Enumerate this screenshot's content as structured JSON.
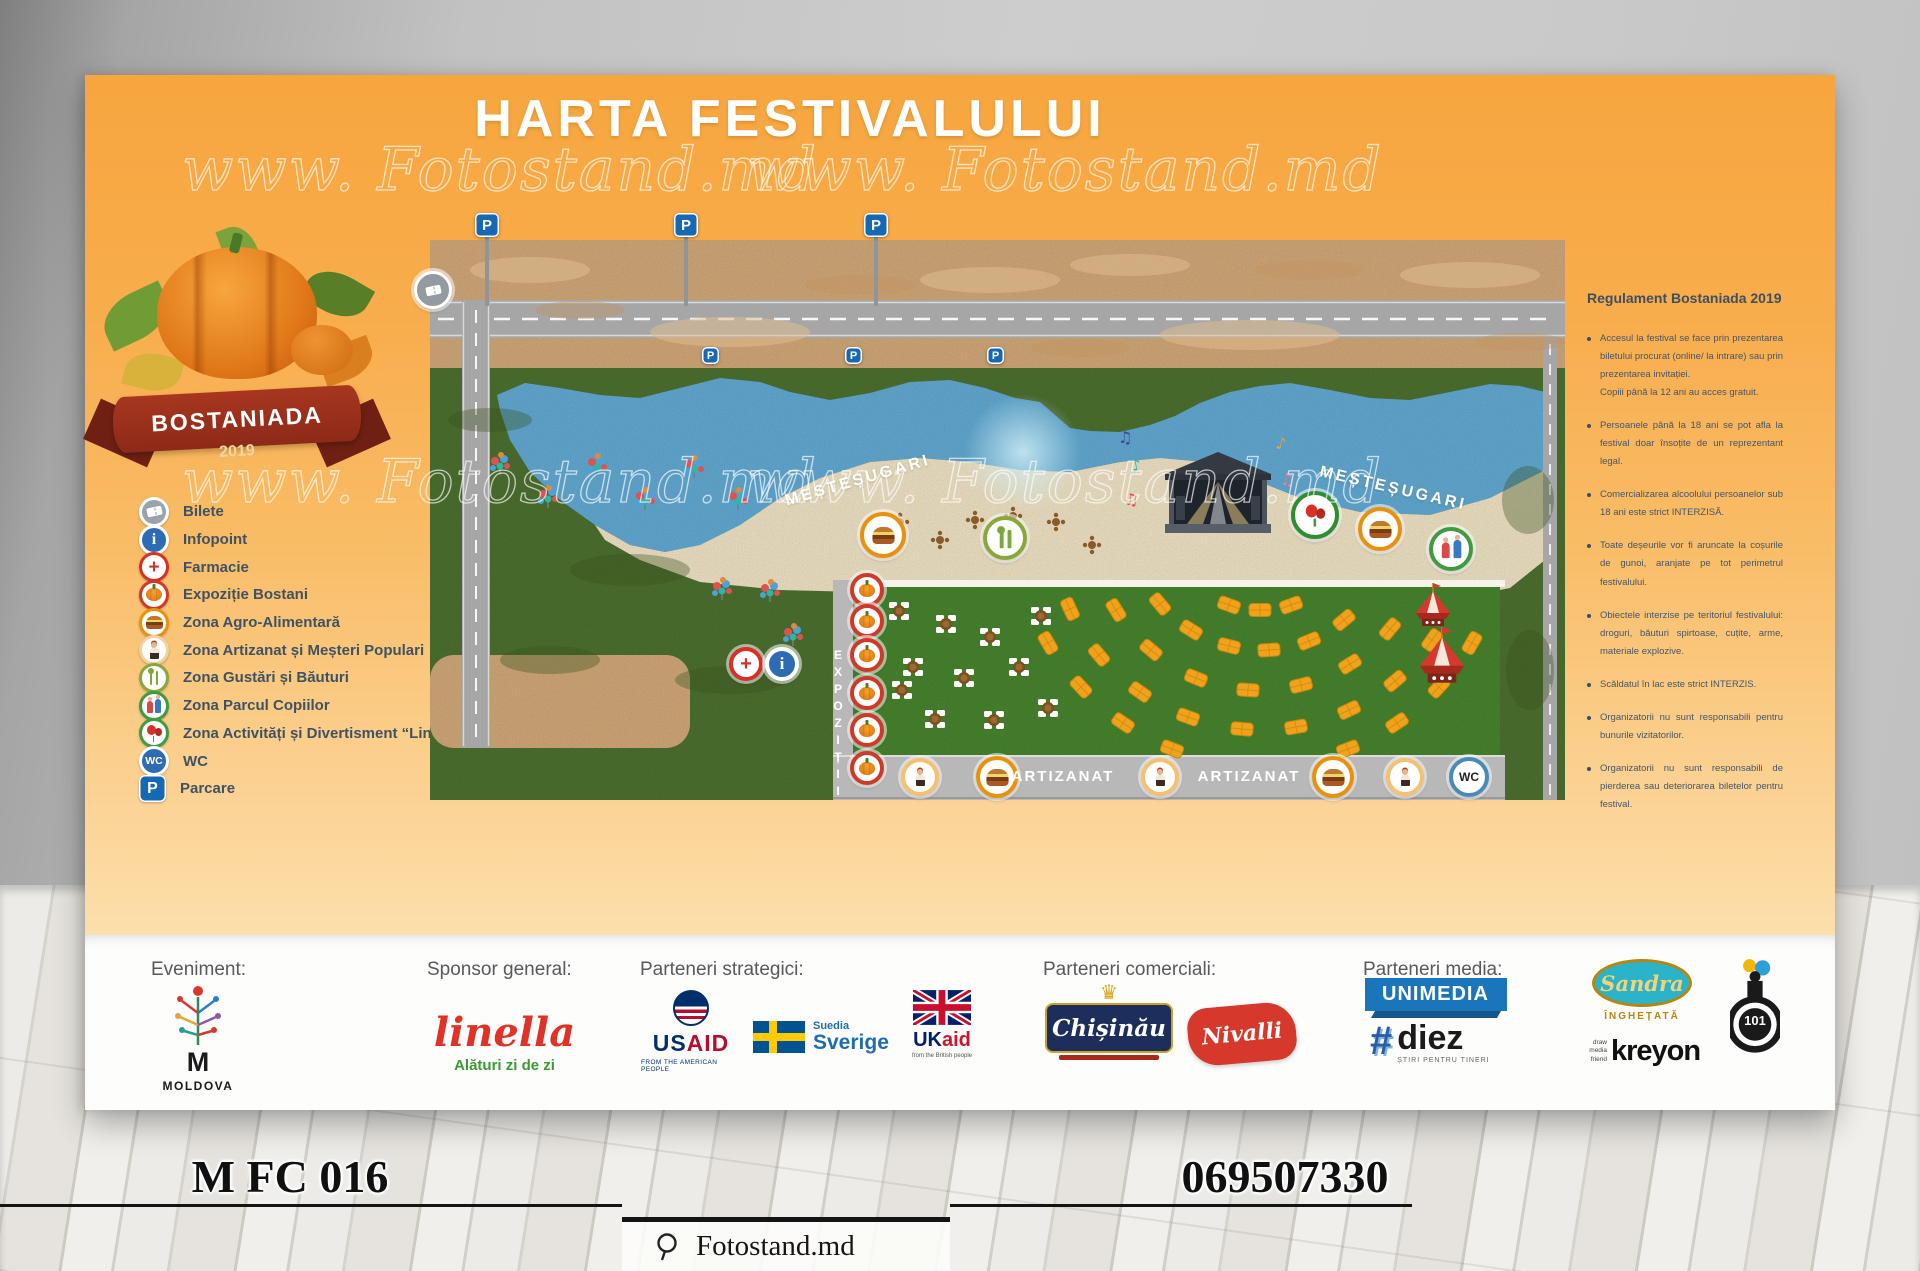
{
  "poster": {
    "title": "HARTA FESTIVALULUI",
    "watermark": "www. Fotostand.md",
    "logo": {
      "name": "BOSTANIADA",
      "year": "2019"
    },
    "legend": {
      "items": [
        {
          "icon": "ticket-icon",
          "label": "Bilete"
        },
        {
          "icon": "info-icon",
          "label": "Infopoint"
        },
        {
          "icon": "pharmacy-icon",
          "label": "Farmacie"
        },
        {
          "icon": "pumpkin-icon",
          "label": "Expoziție Bostani"
        },
        {
          "icon": "food-icon",
          "label": "Zona Agro-Alimentară"
        },
        {
          "icon": "craftsman-icon",
          "label": "Zona Artizanat și Meșteri Populari"
        },
        {
          "icon": "utensils-icon",
          "label": "Zona Gustări și Băuturi"
        },
        {
          "icon": "kids-icon",
          "label": "Zona Parcul Copiilor"
        },
        {
          "icon": "balloons-icon",
          "label": "Zona Activități și Divertisment “Linella”"
        },
        {
          "icon": "wc-icon",
          "label": "WC"
        },
        {
          "icon": "parking-icon",
          "label": "Parcare"
        }
      ]
    },
    "map": {
      "labels": {
        "parking": "P",
        "mestesugari": "MEȘTEȘUGARI",
        "expozitii": "EXPOZIȚII",
        "artizanat": "ARTIZANAT",
        "wc": "WC"
      }
    },
    "rules": {
      "title": "Regulament Bostaniada 2019",
      "bullets": [
        {
          "text": "Accesul la festival se face prin prezentarea biletului procurat (online/ la intrare) sau prin prezentarea invitației.",
          "text2": "Copiii până la 12 ani au acces gratuit."
        },
        {
          "text": "Persoanele până la 18 ani se pot afla la festival doar însoțite de un reprezentant legal."
        },
        {
          "text": "Comercializarea alcoolului persoanelor sub 18 ani este strict INTERZISĂ."
        },
        {
          "text": "Toate deșeurile vor fi aruncate la coșurile de gunoi, aranjate pe tot perimetrul festivalului."
        },
        {
          "text": "Obiectele interzise pe teritoriul festivalului: droguri, băuturi spirtoase, cuțite, arme, materiale explozive."
        },
        {
          "text": "Scăldatul în lac este strict INTERZIS."
        },
        {
          "text": "Organizatorii nu sunt responsabili pentru bunurile vizitatorilor."
        },
        {
          "text": "Organizatorii nu sunt responsabili de pierderea sau deteriorarea biletelor pentru festival."
        }
      ]
    }
  },
  "sponsors": {
    "sections": {
      "event": "Eveniment:",
      "general": "Sponsor general:",
      "strategic": "Parteneri strategici:",
      "commercial": "Parteneri comerciali:",
      "media": "Parteneri media:"
    },
    "moldova": {
      "letter": "M",
      "name": "MOLDOVA"
    },
    "linella": {
      "name": "linella",
      "slogan": "Alături zi de zi"
    },
    "usaid": {
      "us": "US",
      "aid": "AID",
      "caption": "FROM THE AMERICAN PEOPLE"
    },
    "sweden": {
      "country": "Suedia",
      "name": "Sverige"
    },
    "ukaid": {
      "uk": "UK",
      "aid": "aid",
      "caption": "from the British people"
    },
    "chisinau": {
      "name": "Chișinău"
    },
    "nivalli": {
      "name": "Nivalli"
    },
    "unimedia": {
      "name": "UNIMEDIA"
    },
    "diez": {
      "hash": "#",
      "name": "diez",
      "caption": "ȘTIRI PENTRU TINERI"
    },
    "sandra": {
      "name": "Sandra",
      "caption": "ÎNGHEȚATĂ"
    },
    "kreyon": {
      "caption": "draw media friend",
      "name": "kreyon"
    },
    "club101": {
      "name": "101"
    }
  },
  "footer": {
    "code": "M FC 016",
    "site": "Fotostand.md",
    "phone": "069507330"
  },
  "colors": {
    "poster_top": "#f7a63e",
    "poster_bottom": "#fde7bd",
    "lake": "#62a9d2",
    "grass": "#4c7030",
    "field": "#47842e",
    "sand": "#eee2c4",
    "dirt": "#d0a878",
    "road": "#a6a6a6",
    "legend_text": "#3f5264",
    "parking_blue": "#1668b3",
    "ring_red": "#cf3a28",
    "ring_orange": "#e8920c",
    "ring_green": "#2f8f2f"
  }
}
